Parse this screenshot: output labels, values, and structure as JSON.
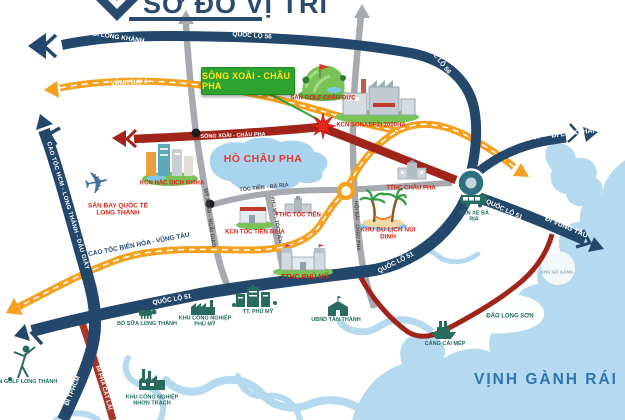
{
  "colors": {
    "navy_road": "#24486B",
    "orange_road": "#F5A01F",
    "red_road": "#A1241B",
    "gray_road": "#A6A9AD",
    "water": "#B5DAF0",
    "label_red": "#D6251B",
    "label_teal": "#1F6B5E",
    "project_box_green": "#2EA32F",
    "project_box_text_yellow": "#FFE11A",
    "title_navy": "#2B4A6F",
    "sea_label_blue": "#2E74B5"
  },
  "header": {
    "title": "SƠ ĐỒ VỊ TRÍ"
  },
  "project": {
    "label": "SÔNG XOÀI - CHÂU PHA"
  },
  "roads": {
    "huong_di_long_khanh": "HƯỚNG ĐI LONG KHÁNH",
    "quoc_lo_56_top": "QUỐC LỘ 56",
    "quoc_lo_56_right": "QUỐC LỘ 56",
    "vanh_dai_4": "VÀNH ĐAI 4",
    "cao_toc_hcm_long_thanh_dau_giay": "CAO TỐC HCM - LONG THÀNH - DẦU GIÂY",
    "cao_toc_bien_hoa_vung_tau": "CAO TỐC BIÊN HÒA - VŨNG TÀU",
    "song_xoai_chau_pha": "SÔNG XOÀI - CHÂU PHA",
    "dt_44": "ĐT 44",
    "di_long_hai": "ĐI LONG HẢI",
    "di_vung_tau": "ĐI VŨNG TÀU",
    "quoc_lo_51_ne": "QUỐC LỘ 51",
    "quoc_lo_51_mid": "QUỐC LỘ 51",
    "quoc_lo_51_west": "QUỐC LỘ 51",
    "di_bien_hoa": "ĐI BIÊN HÒA",
    "di_tphcm": "ĐI TPHCM",
    "di_pha_cat_lai": "ĐI PHÀ CÁT LÁI",
    "my_xuan_ngai_giao": "MỸ XUÂN - NGÃI GIAO",
    "toc_tien_ba_ria": "TÓC TIÊN - BÀ RỊA",
    "phu_my_toc_tien": "PHÚ MỸ - TÓC TIÊN",
    "hoi_bai_chau_pha": "HỘI BÀI - CHÂU PHA"
  },
  "landmarks": {
    "san_golf_chau_duc": "SÂN GOLF CHÂU ĐỨC",
    "kcn_sonadezi": "KCN SONADEZI 2000HA",
    "kcn_hac_dich": "KCN HẮC DỊCH 600HA",
    "san_bay_quoc_te_long_thanh": "SÂN BAY QUỐC TẾ LONG THÀNH",
    "kcn_toc_tien": "KCN TÓC TIÊN 60HA",
    "tthc_toc_tien": "TTHC TÓC TIÊN",
    "tthc_chau_pha": "TTHC CHÂU PHA",
    "tthc_phu_my": "TTHC PHÚ MỸ",
    "khu_du_lich_nui_dinh": "KHU DU LỊCH NÚI DINH",
    "san_golf_long_thanh": "SÂN GOLF LONG THÀNH",
    "bo_sua_long_thanh": "BÒ SỮA LONG THÀNH",
    "khu_cong_nghiep_phu_my": "KHU CÔNG NGHIỆP PHÚ MỸ",
    "tt_phu_my": "TT. PHÚ MỸ",
    "ubnd_tan_thanh": "UBND TÂN THÀNH",
    "khu_cong_nghiep_nhon_trach": "KHU CÔNG NGHIỆP NHƠN TRẠCH",
    "ben_xe_ba_ria": "BẾN XE BÀ RỊA",
    "cang_cai_mep": "CẢNG CÁI MÉP",
    "dao_long_son": "ĐẢO LONG SƠN",
    "khu_go_gang": "KHU GÒ GĂNG"
  },
  "water": {
    "ho_chau_pha": "HỒ CHÂU PHA",
    "vinh_ganh_rai": "VỊNH GÀNH RÁI"
  },
  "icons": {
    "airplane": "✈"
  }
}
